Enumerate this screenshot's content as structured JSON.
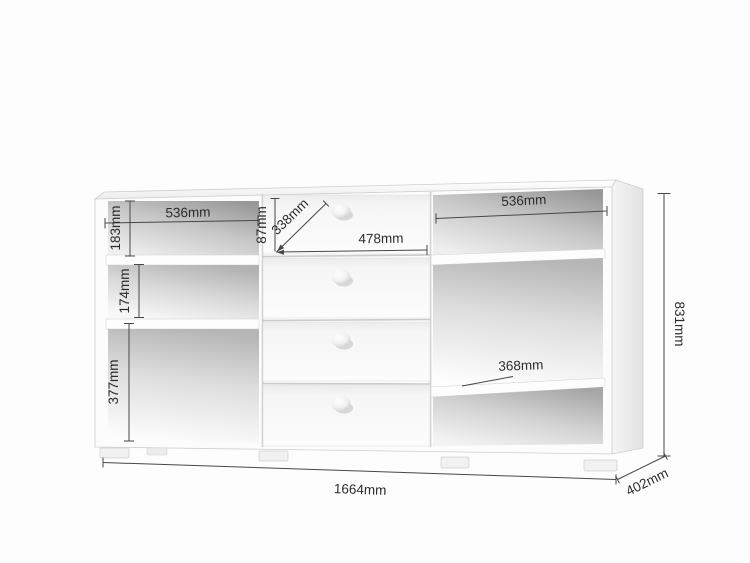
{
  "diagram": {
    "subject": "sideboard with open side shelves and four center drawers",
    "unit": "mm",
    "colors": {
      "background": "#fdfdfd",
      "furniture_panel": "#fcfcfc",
      "interior_shadow": "#989898",
      "dimension_line": "#474747",
      "dimension_text": "#2b2b2b"
    },
    "dimensions": {
      "left_compartment_width": "536mm",
      "left_top_compartment_height": "183mm",
      "left_middle_compartment_height": "174mm",
      "left_bottom_compartment_height": "377mm",
      "top_drawer_height": "87mm",
      "drawer_diagonal": "338mm",
      "drawer_width": "478mm",
      "right_compartment_width": "536mm",
      "right_shelf_depth": "368mm",
      "overall_height": "831mm",
      "overall_width": "1664mm",
      "overall_depth": "402mm"
    }
  }
}
